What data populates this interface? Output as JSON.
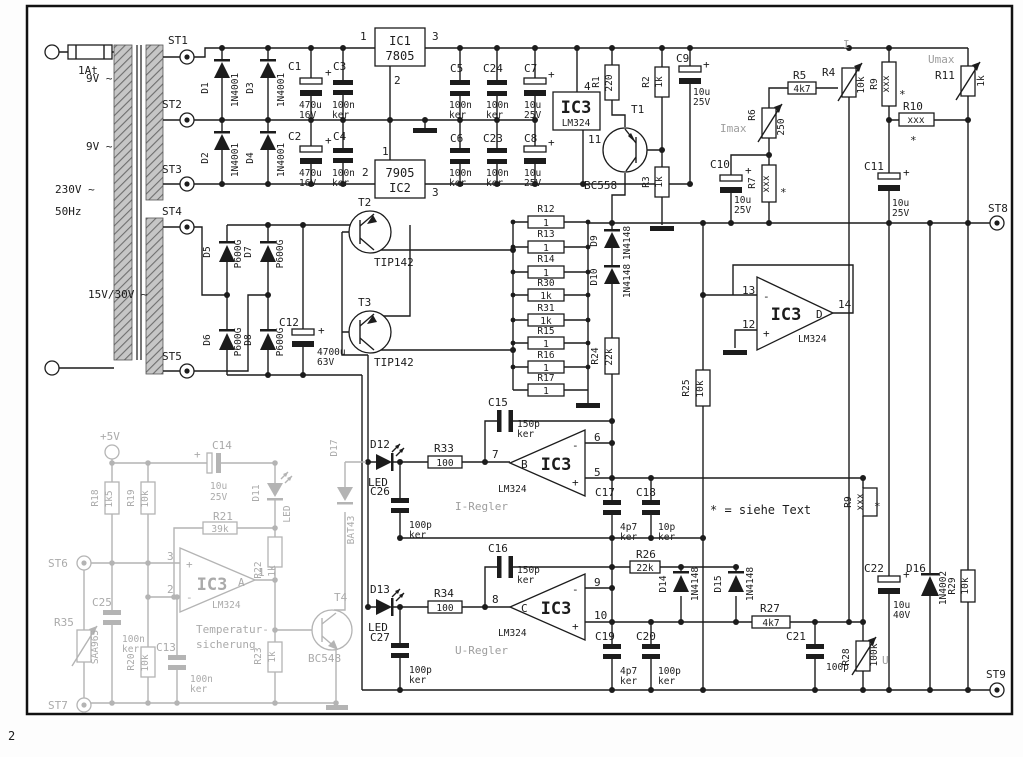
{
  "meta": {
    "ink": "#1c1c1c",
    "gray": "#b4b4b4",
    "corner_mark": "2"
  },
  "sym": {
    "plus": "+",
    "star": "*",
    "minus": "-"
  },
  "power_input": {
    "fuse": "1At",
    "mains_v": "230V ~",
    "mains_f": "50Hz",
    "w1": "9V ~",
    "w2": "9V ~",
    "w3": "15V/30V ~",
    "st1": "ST1",
    "st2": "ST2",
    "st3": "ST3",
    "st4": "ST4",
    "st5": "ST5"
  },
  "aux": {
    "ic1_ref": "IC1",
    "ic1_type": "7805",
    "ic1_p1": "1",
    "ic1_p2": "2",
    "ic1_p3": "3",
    "ic2_type": "7905",
    "ic2_ref": "IC2",
    "ic2_p1": "1",
    "ic2_p2": "2",
    "ic2_p3": "3",
    "d1": "D1",
    "d1_t": "1N4001",
    "d3": "D3",
    "d3_t": "1N4001",
    "d2": "D2",
    "d2_t": "1N4001",
    "d4": "D4",
    "d4_t": "1N4001",
    "c1": "C1",
    "c1_v": "470u",
    "c1_u": "16V",
    "c3": "C3",
    "c3_v": "100n",
    "c3_u": "ker",
    "c2": "C2",
    "c2_v": "470u",
    "c2_u": "16V",
    "c4": "C4",
    "c4_v": "100n",
    "c4_u": "ker",
    "c5": "C5",
    "c5_v": "100n",
    "c5_u": "ker",
    "c24": "C24",
    "c24_v": "100n",
    "c24_u": "ker",
    "c7": "C7",
    "c7_v": "10u",
    "c7_u": "25V",
    "c6": "C6",
    "c6_v": "100n",
    "c6_u": "ker",
    "c23": "C23",
    "c23_v": "100n",
    "c23_u": "ker",
    "c8": "C8",
    "c8_v": "10u",
    "c8_u": "25V",
    "ic3p_ref": "IC3",
    "ic3p_type": "LM324",
    "ic3p_p4": "4",
    "ic3p_p11": "11"
  },
  "mainrect": {
    "d5": "D5",
    "d5_t": "P600G",
    "d7": "D7",
    "d7_t": "P600G",
    "d6": "D6",
    "d6_t": "P600G",
    "d8": "D8",
    "d8_t": "P600G",
    "c12": "C12",
    "c12_v": "4700u",
    "c12_u": "63V",
    "t2": "T2",
    "t2_t": "TIP142",
    "t3": "T3",
    "t3_t": "TIP142"
  },
  "tsource": {
    "r1": "R1",
    "r1_v": "220",
    "r2": "R2",
    "r2_v": "1k",
    "r3": "R3",
    "r3_v": "1k",
    "t1": "T1",
    "t1_t": "BC558",
    "c9": "C9",
    "c9_v": "10u",
    "c9_u": "25V"
  },
  "sense": {
    "r12": "R12",
    "r12_v": "1",
    "r13": "R13",
    "r13_v": "1",
    "r14": "R14",
    "r14_v": "1",
    "r30": "R30",
    "r30_v": "1k",
    "r31": "R31",
    "r31_v": "1k",
    "r15": "R15",
    "r15_v": "1",
    "r16": "R16",
    "r16_v": "1",
    "r17": "R17",
    "r17_v": "1",
    "d9": "D9",
    "d9_t": "1N4148",
    "d10": "D10",
    "d10_t": "1N4148",
    "r24": "R24",
    "r24_v": "22k",
    "r25": "R25",
    "r25_v": "10k"
  },
  "setpoint": {
    "imax": "Imax",
    "i": "I",
    "umax": "Umax",
    "u": "U",
    "r4": "R4",
    "r4_v": "10k",
    "r5": "R5",
    "r5_v": "4k7",
    "r6": "R6",
    "r6_v": "250",
    "r7": "R7",
    "r7_v": "xxx",
    "c10": "C10",
    "c10_v": "10u",
    "c10_u": "25V",
    "r9a": "R9",
    "r9a_v": "xxx",
    "r10": "R10",
    "r10_v": "xxx",
    "r11": "R11",
    "r11_v": "1k",
    "c11": "C11",
    "c11_v": "10u",
    "c11_u": "25V",
    "r9b": "R9",
    "r9b_v": "xxx",
    "footnote": "* = siehe Text"
  },
  "opamp_d": {
    "ref": "IC3",
    "type": "LM324",
    "sec": "D",
    "p13": "13",
    "p12": "12",
    "p14": "14"
  },
  "i_regler": {
    "title": "I-Regler",
    "d12": "D12",
    "d12_t": "LED",
    "r33": "R33",
    "r33_v": "100",
    "c15": "C15",
    "c15_v": "150p",
    "c15_u": "ker",
    "ref": "IC3",
    "type": "LM324",
    "sec": "B",
    "p7": "7",
    "p6": "6",
    "p5": "5",
    "c26": "C26",
    "c26_v": "100p",
    "c26_u": "ker",
    "c17": "C17",
    "c17_v": "4p7",
    "c17_u": "ker",
    "c18": "C18",
    "c18_v": "10p",
    "c18_u": "ker"
  },
  "u_regler": {
    "title": "U-Regler",
    "d13": "D13",
    "d13_t": "LED",
    "r34": "R34",
    "r34_v": "100",
    "c16": "C16",
    "c16_v": "150p",
    "c16_u": "ker",
    "ref": "IC3",
    "type": "LM324",
    "sec": "C",
    "p8": "8",
    "p9": "9",
    "p10": "10",
    "c27": "C27",
    "c27_v": "100p",
    "c27_u": "ker",
    "c19": "C19",
    "c19_v": "4p7",
    "c19_u": "ker",
    "c20": "C20",
    "c20_v": "100p",
    "c20_u": "ker",
    "r26": "R26",
    "r26_v": "22k",
    "d14": "D14",
    "d14_t": "1N4148",
    "d15": "D15",
    "d15_t": "1N4148",
    "r27": "R27",
    "r27_v": "4k7",
    "c21": "C21",
    "c21_v": "100p",
    "r28": "R28",
    "r28_v": "100k"
  },
  "output": {
    "st8": "ST8",
    "st9": "ST9",
    "c22": "C22",
    "c22_v": "10u",
    "c22_u": "40V",
    "d16": "D16",
    "d16_t": "1N4002",
    "r29": "R29",
    "r29_v": "10k"
  },
  "temp": {
    "title1": "Temperatur-",
    "title2": "sicherung",
    "plus5": "+5V",
    "st6": "ST6",
    "st7": "ST7",
    "r18": "R18",
    "r18_v": "1k5",
    "r19": "R19",
    "r19_v": "10k",
    "r20": "R20",
    "r20_v": "10k",
    "r21": "R21",
    "r21_v": "39k",
    "r22": "R22",
    "r22_v": "1k",
    "r23": "R23",
    "r23_v": "1k",
    "r35": "R35",
    "r35_t": "SAA965",
    "c13": "C13",
    "c13_v": "100n",
    "c13_u": "ker",
    "c14": "C14",
    "c14_v": "10u",
    "c14_u": "25V",
    "c25": "C25",
    "c25_v": "100n",
    "c25_u": "ker",
    "d11": "D11",
    "d11_t": "LED",
    "d17": "D17",
    "d17_t": "BAT43",
    "t4": "T4",
    "t4_t": "BC548",
    "ref": "IC3",
    "type": "LM324",
    "sec": "A",
    "p3": "3",
    "p2": "2",
    "p1": "1"
  }
}
